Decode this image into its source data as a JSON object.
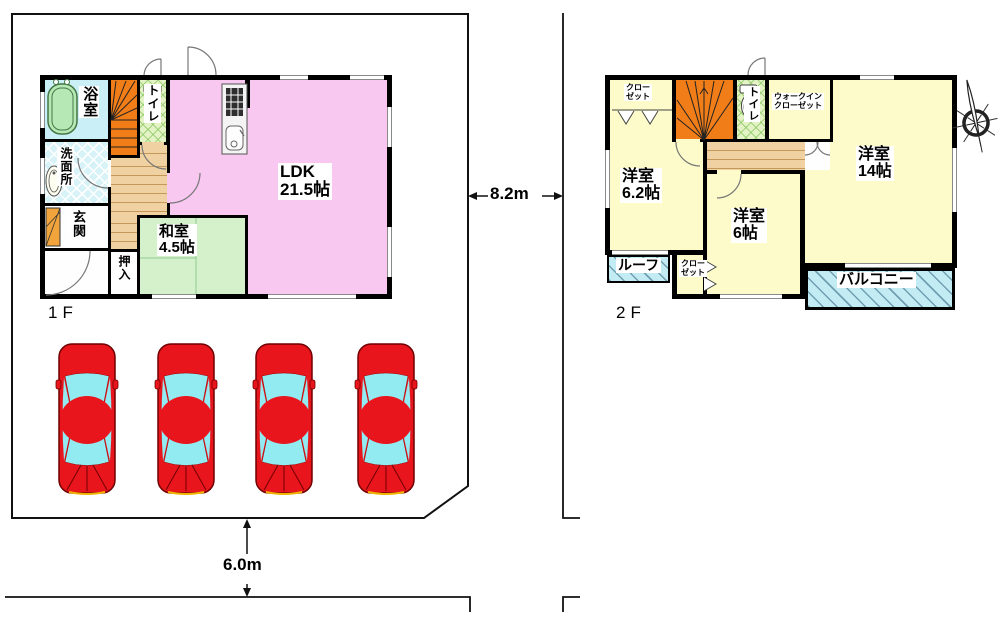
{
  "floor1": {
    "label": "1F",
    "ldk": {
      "name": "LDK",
      "size": "21.5帖"
    },
    "washitsu": {
      "name": "和室",
      "size": "4.5帖"
    },
    "bath": {
      "name": "浴室"
    },
    "toilet": {
      "name": "トイレ"
    },
    "washroom": {
      "name": "洗面所"
    },
    "entrance": {
      "name": "玄関"
    },
    "oshiire": {
      "name": "押入"
    }
  },
  "floor2": {
    "label": "2F",
    "west62": {
      "name": "洋室",
      "size": "6.2帖"
    },
    "west6": {
      "name": "洋室",
      "size": "6帖"
    },
    "west14": {
      "name": "洋室",
      "size": "14帖"
    },
    "toilet": {
      "name": "トイレ"
    },
    "wic": {
      "line1": "ウォークイン",
      "line2": "クローゼット"
    },
    "closet_top": {
      "line1": "クロー",
      "line2": "ゼット"
    },
    "closet_bottom": {
      "line1": "クロー",
      "line2": "ゼット"
    },
    "roof": {
      "name": "ルーフ"
    },
    "balcony": {
      "name": "バルコニー"
    }
  },
  "dimensions": {
    "frontage": "6.0m",
    "depth": "8.2m"
  },
  "parking": {
    "car_count": 4
  },
  "colors": {
    "wall": "#000000",
    "ldk_pink": "#F8C8F0",
    "tatami_green": "#D4F1CC",
    "room_yellow": "#FCFBC9",
    "stairs_orange": "#F07D18",
    "bath_blue": "#CBEFF7",
    "hatch_cyan": "#C2EBF3",
    "wood_tan": "#F0D2A2",
    "car_red": "#E8151C",
    "glass_cyan": "#93EBF2"
  }
}
